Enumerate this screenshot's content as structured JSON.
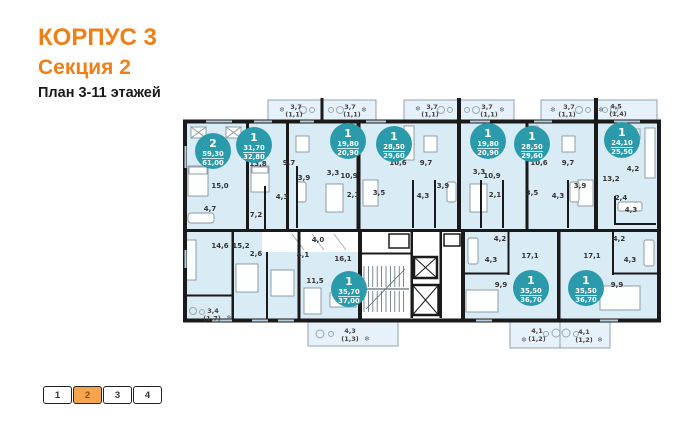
{
  "title": {
    "building": "КОРПУС 3",
    "section": "Секция 2",
    "floors": "План 3-11 этажей"
  },
  "colors": {
    "accent_orange": "#ef8018",
    "badge_teal": "#2b9bac",
    "apartment_fill": "#d9ebf5",
    "balcony_fill": "#e6f1f9",
    "wall": "#1a1a1a"
  },
  "icons": {
    "ac_unit": "❄"
  },
  "key_plan": {
    "sections": [
      "1",
      "2",
      "3",
      "4"
    ],
    "active_section": "2"
  },
  "plan": {
    "apartments": [
      {
        "rooms": "2",
        "area_living": "59,30",
        "area_total": "61,00"
      },
      {
        "rooms": "1",
        "area_living": "31,70",
        "area_total": "32,80"
      },
      {
        "rooms": "1",
        "area_living": "19,80",
        "area_total": "20,90"
      },
      {
        "rooms": "1",
        "area_living": "28,50",
        "area_total": "29,60"
      },
      {
        "rooms": "1",
        "area_living": "19,80",
        "area_total": "20,90"
      },
      {
        "rooms": "1",
        "area_living": "28,50",
        "area_total": "29,60"
      },
      {
        "rooms": "1",
        "area_living": "24,10",
        "area_total": "25,50"
      },
      {
        "rooms": "1",
        "area_living": "35,70",
        "area_total": "37,00"
      },
      {
        "rooms": "1",
        "area_living": "35,50",
        "area_total": "36,70"
      },
      {
        "rooms": "1",
        "area_living": "35,50",
        "area_total": "36,70"
      }
    ],
    "room_labels": [
      "15,0",
      "13,8",
      "9,7",
      "3,9",
      "4,3",
      "7,2",
      "4,7",
      "3,3",
      "10,9",
      "2,1",
      "3,5",
      "4,3",
      "3,9",
      "10,6",
      "9,7",
      "3,3",
      "10,9",
      "2,1",
      "3,5",
      "4,3",
      "3,9",
      "10,6",
      "9,7",
      "13,2",
      "4,2",
      "2,4",
      "4,3",
      "14,6",
      "15,2",
      "2,6",
      "4,1",
      "4,0",
      "16,1",
      "11,5",
      "17,1",
      "4,2",
      "4,3",
      "9,9",
      "17,1",
      "4,2",
      "4,3",
      "9,9"
    ],
    "balcony_labels": [
      {
        "area": "3,7",
        "extra": "(1,1)"
      },
      {
        "area": "3,7",
        "extra": "(1,1)"
      },
      {
        "area": "3,7",
        "extra": "(1,1)"
      },
      {
        "area": "3,7",
        "extra": "(1,1)"
      },
      {
        "area": "3,7",
        "extra": "(1,1)"
      },
      {
        "area": "4,5",
        "extra": "(1,4)"
      },
      {
        "area": "4,3",
        "extra": "(1,3)"
      },
      {
        "area": "4,1",
        "extra": "(1,2)"
      },
      {
        "area": "4,1",
        "extra": "(1,2)"
      },
      {
        "area": "3,4",
        "extra": "(1,7)"
      }
    ]
  }
}
